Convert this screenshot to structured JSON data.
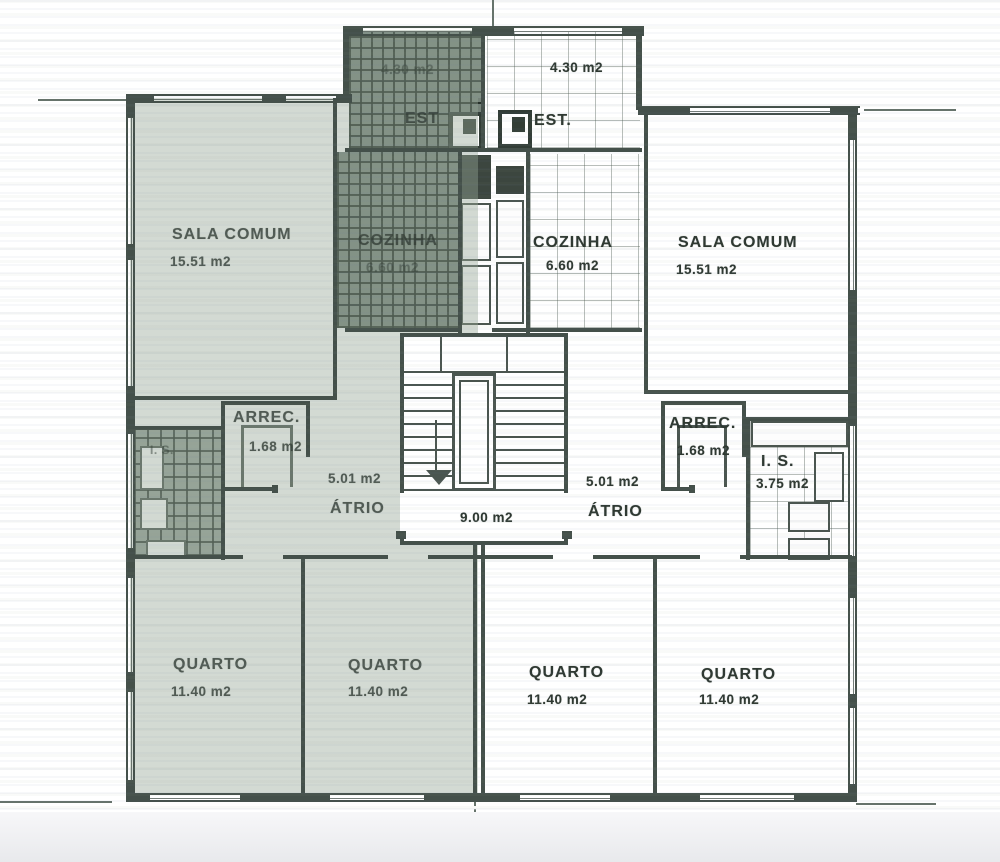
{
  "plan": {
    "left_apartment": {
      "sala_comum": {
        "name": "SALA COMUM",
        "area": "15.51 m2"
      },
      "est": {
        "name": "EST",
        "area": "4.30 m2"
      },
      "cozinha": {
        "name": "COZINHA",
        "area": "6.60 m2"
      },
      "arrec": {
        "name": "ARREC.",
        "area": "1.68 m2"
      },
      "is": {
        "name": "I. S."
      },
      "atrio": {
        "name": "ÁTRIO",
        "area": "5.01 m2"
      },
      "quarto_1": {
        "name": "QUARTO",
        "area": "11.40 m2"
      },
      "quarto_2": {
        "name": "QUARTO",
        "area": "11.40 m2"
      }
    },
    "stairwell": {
      "area": "9.00 m2"
    },
    "right_apartment": {
      "est": {
        "name": "EST.",
        "area": "4.30 m2"
      },
      "cozinha": {
        "name": "COZINHA",
        "area": "6.60 m2"
      },
      "sala_comum": {
        "name": "SALA COMUM",
        "area": "15.51 m2"
      },
      "arrec": {
        "name": "ARREC.",
        "area": "1.68 m2"
      },
      "is": {
        "name": "I. S.",
        "area": "3.75 m2"
      },
      "atrio": {
        "name": "ÁTRIO",
        "area": "5.01 m2"
      },
      "quarto_1": {
        "name": "QUARTO",
        "area": "11.40 m2"
      },
      "quarto_2": {
        "name": "QUARTO",
        "area": "11.40 m2"
      }
    },
    "colors": {
      "wall_line": "#44504a",
      "left_apartment_tint": "#96a697",
      "hatch_dark": "#76837a",
      "label_text": "#2e3831"
    }
  }
}
